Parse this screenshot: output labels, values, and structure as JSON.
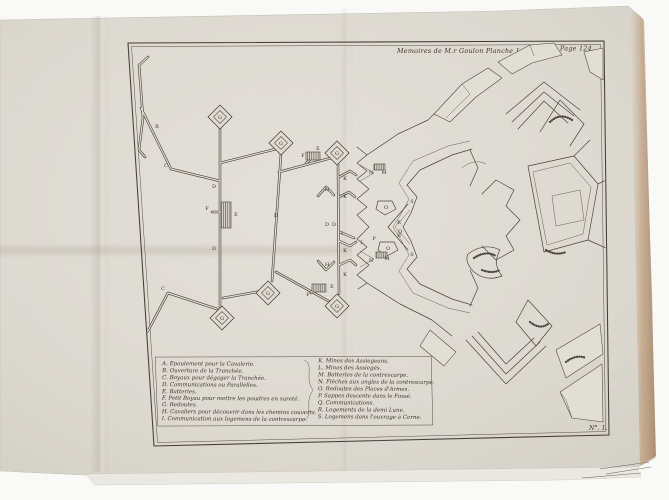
{
  "plate": {
    "header_left": "Memoires de M.r Goulon Planche 1.re",
    "header_right": "Page 124.",
    "plate_number": "N°. 1."
  },
  "legend": {
    "left": [
      "A. Epaulement pour la Cavalerie.",
      "B. Ouverture de la Tranchée.",
      "C. Boyaux pour dégager la Tranchée.",
      "D. Communications ou Parallelles.",
      "E. Batteries.",
      "F. Petit Boyau pour mettre les poudres en sureté.",
      "G. Redoutes.",
      "H. Cavaliers pour découvrir dans les chemins couverts.",
      "I. Communication aux logemens de la contrescarpe."
    ],
    "right": [
      "K. Mines des Assiegeans.",
      "L. Mines des Assiegés.",
      "M. Batteries de la contrescarpe.",
      "N. Flèches aux angles de la contrescarpe.",
      "O. Redoutes des Places d'Armes.",
      "P. Sappes descente dans le Fossé.",
      "Q. Communications.",
      "R. Logements de la demi Lune.",
      "S. Logemens dans l'ouvrage à Corne."
    ]
  },
  "map_labels": [
    {
      "t": "A",
      "x": 126,
      "y": 87
    },
    {
      "t": "B",
      "x": 157,
      "y": 128
    },
    {
      "t": "C",
      "x": 166,
      "y": 167
    },
    {
      "t": "D",
      "x": 214,
      "y": 188
    },
    {
      "t": "F",
      "x": 207,
      "y": 210
    },
    {
      "t": "E",
      "x": 236,
      "y": 216
    },
    {
      "t": "D",
      "x": 214,
      "y": 250
    },
    {
      "t": "C",
      "x": 163,
      "y": 290
    },
    {
      "t": "B",
      "x": 144,
      "y": 314
    },
    {
      "t": "G",
      "x": 220,
      "y": 119
    },
    {
      "t": "G",
      "x": 281,
      "y": 145
    },
    {
      "t": "G",
      "x": 337,
      "y": 155
    },
    {
      "t": "G",
      "x": 222,
      "y": 320
    },
    {
      "t": "G",
      "x": 268,
      "y": 295
    },
    {
      "t": "G",
      "x": 337,
      "y": 308
    },
    {
      "t": "D",
      "x": 276,
      "y": 217
    },
    {
      "t": "D",
      "x": 327,
      "y": 226
    },
    {
      "t": "D",
      "x": 334,
      "y": 226
    },
    {
      "t": "F",
      "x": 303,
      "y": 157
    },
    {
      "t": "E",
      "x": 318,
      "y": 150
    },
    {
      "t": "F",
      "x": 308,
      "y": 296
    },
    {
      "t": "E",
      "x": 332,
      "y": 288
    },
    {
      "t": "H",
      "x": 327,
      "y": 191
    },
    {
      "t": "H",
      "x": 327,
      "y": 266
    },
    {
      "t": "K",
      "x": 345,
      "y": 180
    },
    {
      "t": "K",
      "x": 345,
      "y": 198
    },
    {
      "t": "K",
      "x": 345,
      "y": 252
    },
    {
      "t": "K",
      "x": 345,
      "y": 276
    },
    {
      "t": "I",
      "x": 342,
      "y": 235
    },
    {
      "t": "L",
      "x": 362,
      "y": 244
    },
    {
      "t": "M",
      "x": 384,
      "y": 174
    },
    {
      "t": "N",
      "x": 371,
      "y": 174
    },
    {
      "t": "M",
      "x": 387,
      "y": 260
    },
    {
      "t": "N",
      "x": 371,
      "y": 262
    },
    {
      "t": "O",
      "x": 386,
      "y": 209
    },
    {
      "t": "O",
      "x": 388,
      "y": 250
    },
    {
      "t": "P",
      "x": 374,
      "y": 240
    },
    {
      "t": "Q",
      "x": 400,
      "y": 233
    },
    {
      "t": "R",
      "x": 399,
      "y": 224
    },
    {
      "t": "R",
      "x": 399,
      "y": 237
    },
    {
      "t": "S",
      "x": 412,
      "y": 203
    },
    {
      "t": "S",
      "x": 412,
      "y": 256
    }
  ],
  "colors": {
    "background": "#f9f9f7",
    "paper": "#dedbd3",
    "ink": "#494135",
    "page_edge": "#b08a63"
  }
}
